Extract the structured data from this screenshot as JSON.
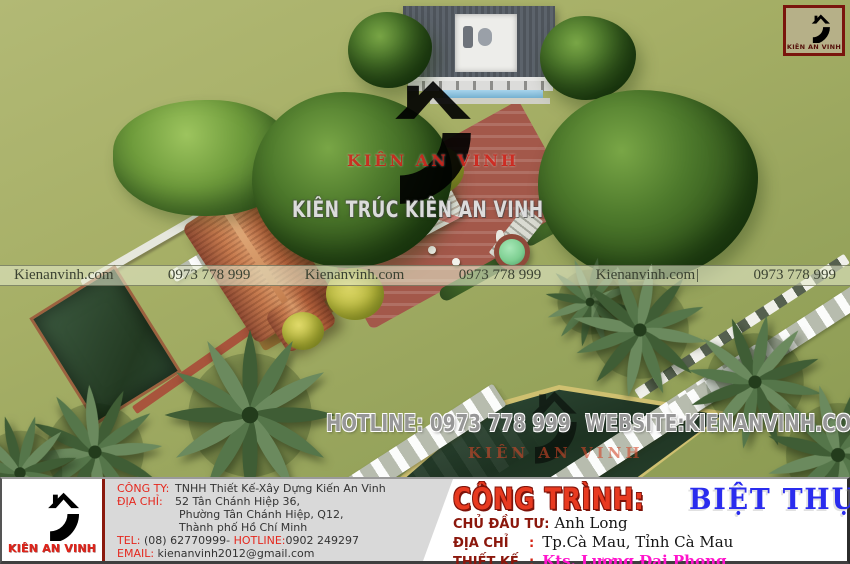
{
  "watermarks": {
    "center_logo_text": "KIÊN AN VINH",
    "center_title": "KIÊN TRÚC KIÊN AN VINH",
    "bottom_logo_text": "KIÊN AN VINH",
    "band": {
      "segments": [
        "Kienanvinh.com",
        "0973 778 999",
        "Kienanvinh.com",
        "0973 778 999",
        "Kienanvinh.com",
        "0973 778 999"
      ],
      "cursor": "|"
    },
    "hotline": {
      "hotline_label": "HOTLINE:",
      "hotline_number": "0973 778 999",
      "website_label": "WEBSITE:",
      "website_value": "KIENANVINH.COM"
    }
  },
  "logo_box": {
    "brand": "KIÊN AN VINH"
  },
  "footer": {
    "brand": "KIÊN AN VINH",
    "company": {
      "label_company": "CÔNG TY:",
      "name": "TNHH Thiết Kế-Xây Dựng Kiến An Vinh",
      "label_address": "ĐỊA CHỈ:",
      "address_line1": "52 Tân Chánh Hiệp 36,",
      "address_line2": "Phường Tân Chánh Hiệp, Q12,",
      "address_line3": "Thành phố Hồ Chí Minh",
      "label_tel": "TEL:",
      "tel_value": "(08) 62770999-",
      "label_hotline": "HOTLINE:",
      "hotline_value": "0902 249297",
      "label_email": "EMAIL:",
      "email_value": "kienanvinh2012@gmail.com"
    },
    "project": {
      "label_project": "CÔNG TRÌNH:",
      "project_value": "BIỆT THỰ",
      "label_owner": "CHỦ ĐẦU TƯ:",
      "owner_value": "Anh Long",
      "label_address": "ĐỊA CHỈ",
      "address_colon": ":",
      "address_value": "Tp.Cà Mau, Tỉnh Cà Mau",
      "label_design": "THIẾT KẾ",
      "design_colon": ":",
      "design_value": "Kts. Lương Đại Phong"
    }
  },
  "colors": {
    "brand_red": "#e0241a",
    "label_red": "#e5281e",
    "maroon": "#8b170c",
    "project_blue": "#2a2cee",
    "designer_magenta": "#ff14cc",
    "lawn_green": "#9fae60",
    "terracotta_roof": "#b5643f",
    "watermark_gray": "#e8e8e8"
  }
}
